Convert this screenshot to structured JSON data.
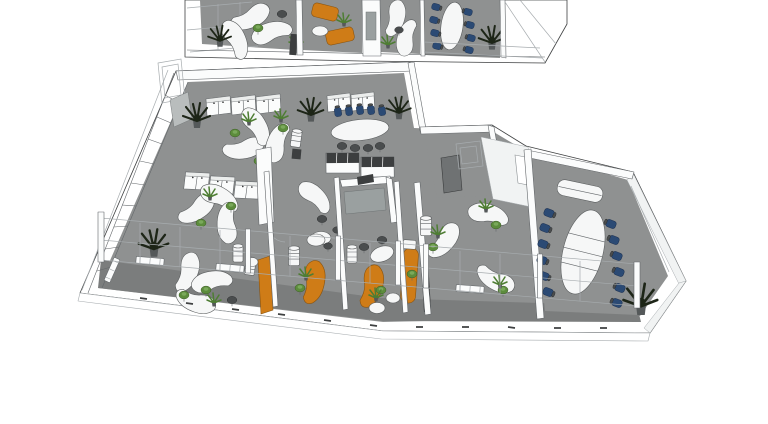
{
  "meta": {
    "title": "3D isometric office floor plan rendering",
    "render_style": "sketchup-wireframe",
    "visible_text": "none"
  },
  "colors": {
    "background": "#ffffff",
    "floor": "#8f9191",
    "floor_dark": "#7b7d7d",
    "wall_white": "#fbfcfc",
    "wall_face": "#f1f3f3",
    "line_dark": "#3f4142",
    "line_mid": "#63676a",
    "line_light": "#a7acaf",
    "desk_white": "#f6f7f7",
    "desk_edge": "#5c5f60",
    "accent_orange": "#cf7c17",
    "chair_green": "#5c8c3c",
    "chair_navy": "#2b4a74",
    "chair_dark": "#4a4d4e",
    "plant_dark": "#1d2517",
    "plant_green": "#4e7d33",
    "pot_gray": "#55595a",
    "wall_gray_segment": "#b9bdbd"
  },
  "scene": {
    "sections": [
      {
        "name": "upper-floor-strip",
        "position": "top edge, partially cut off",
        "rooms": [
          {
            "name": "open-desk-area",
            "furniture": [
              "curved-white-desks",
              "green-task-chairs",
              "potted-plants",
              "terrace-railing"
            ]
          },
          {
            "name": "lounge",
            "furniture": [
              "orange-sofas",
              "white-coffee-table",
              "plant",
              "media-panel"
            ]
          },
          {
            "name": "desk-area-2",
            "furniture": [
              "curved-white-desks",
              "dark-task-chairs"
            ]
          },
          {
            "name": "meeting-room",
            "furniture": [
              "white-oval-table",
              "navy-chairs",
              "potted-plant"
            ]
          }
        ]
      },
      {
        "name": "main-floor",
        "position": "center, large L-shaped slab",
        "rooms": [
          {
            "name": "open-office",
            "furniture": [
              "three-desk-clusters",
              "curved-white-desks",
              "green-task-chairs",
              "white-storage-cabinets",
              "stool-stacks",
              "potted-plants",
              "window-wall",
              "radiators"
            ]
          },
          {
            "name": "meeting-area",
            "furniture": [
              "white-oval-table",
              "five-navy-chairs",
              "four-dark-chairs",
              "sideboard-cabinets",
              "glass-front-cabinets"
            ]
          },
          {
            "name": "private-offices",
            "furniture": [
              "orange-curved-desks",
              "green-task-chairs",
              "round-white-tables",
              "drawer-pedestals",
              "glass-partitions",
              "privacy-panels"
            ]
          },
          {
            "name": "utility-core",
            "furniture": [
              "dark-door",
              "white-room",
              "glass-frame"
            ]
          },
          {
            "name": "team-room",
            "furniture": [
              "three-curved-white-desks",
              "green-task-chairs",
              "desk-plants"
            ]
          },
          {
            "name": "conference-room",
            "furniture": [
              "large-white-oval-table",
              "twelve-navy-chairs",
              "credenza",
              "potted-plant"
            ]
          }
        ],
        "front": [
          "glazed-facade",
          "corridor-strip",
          "white-posts",
          "slab-edge-band"
        ]
      }
    ]
  }
}
